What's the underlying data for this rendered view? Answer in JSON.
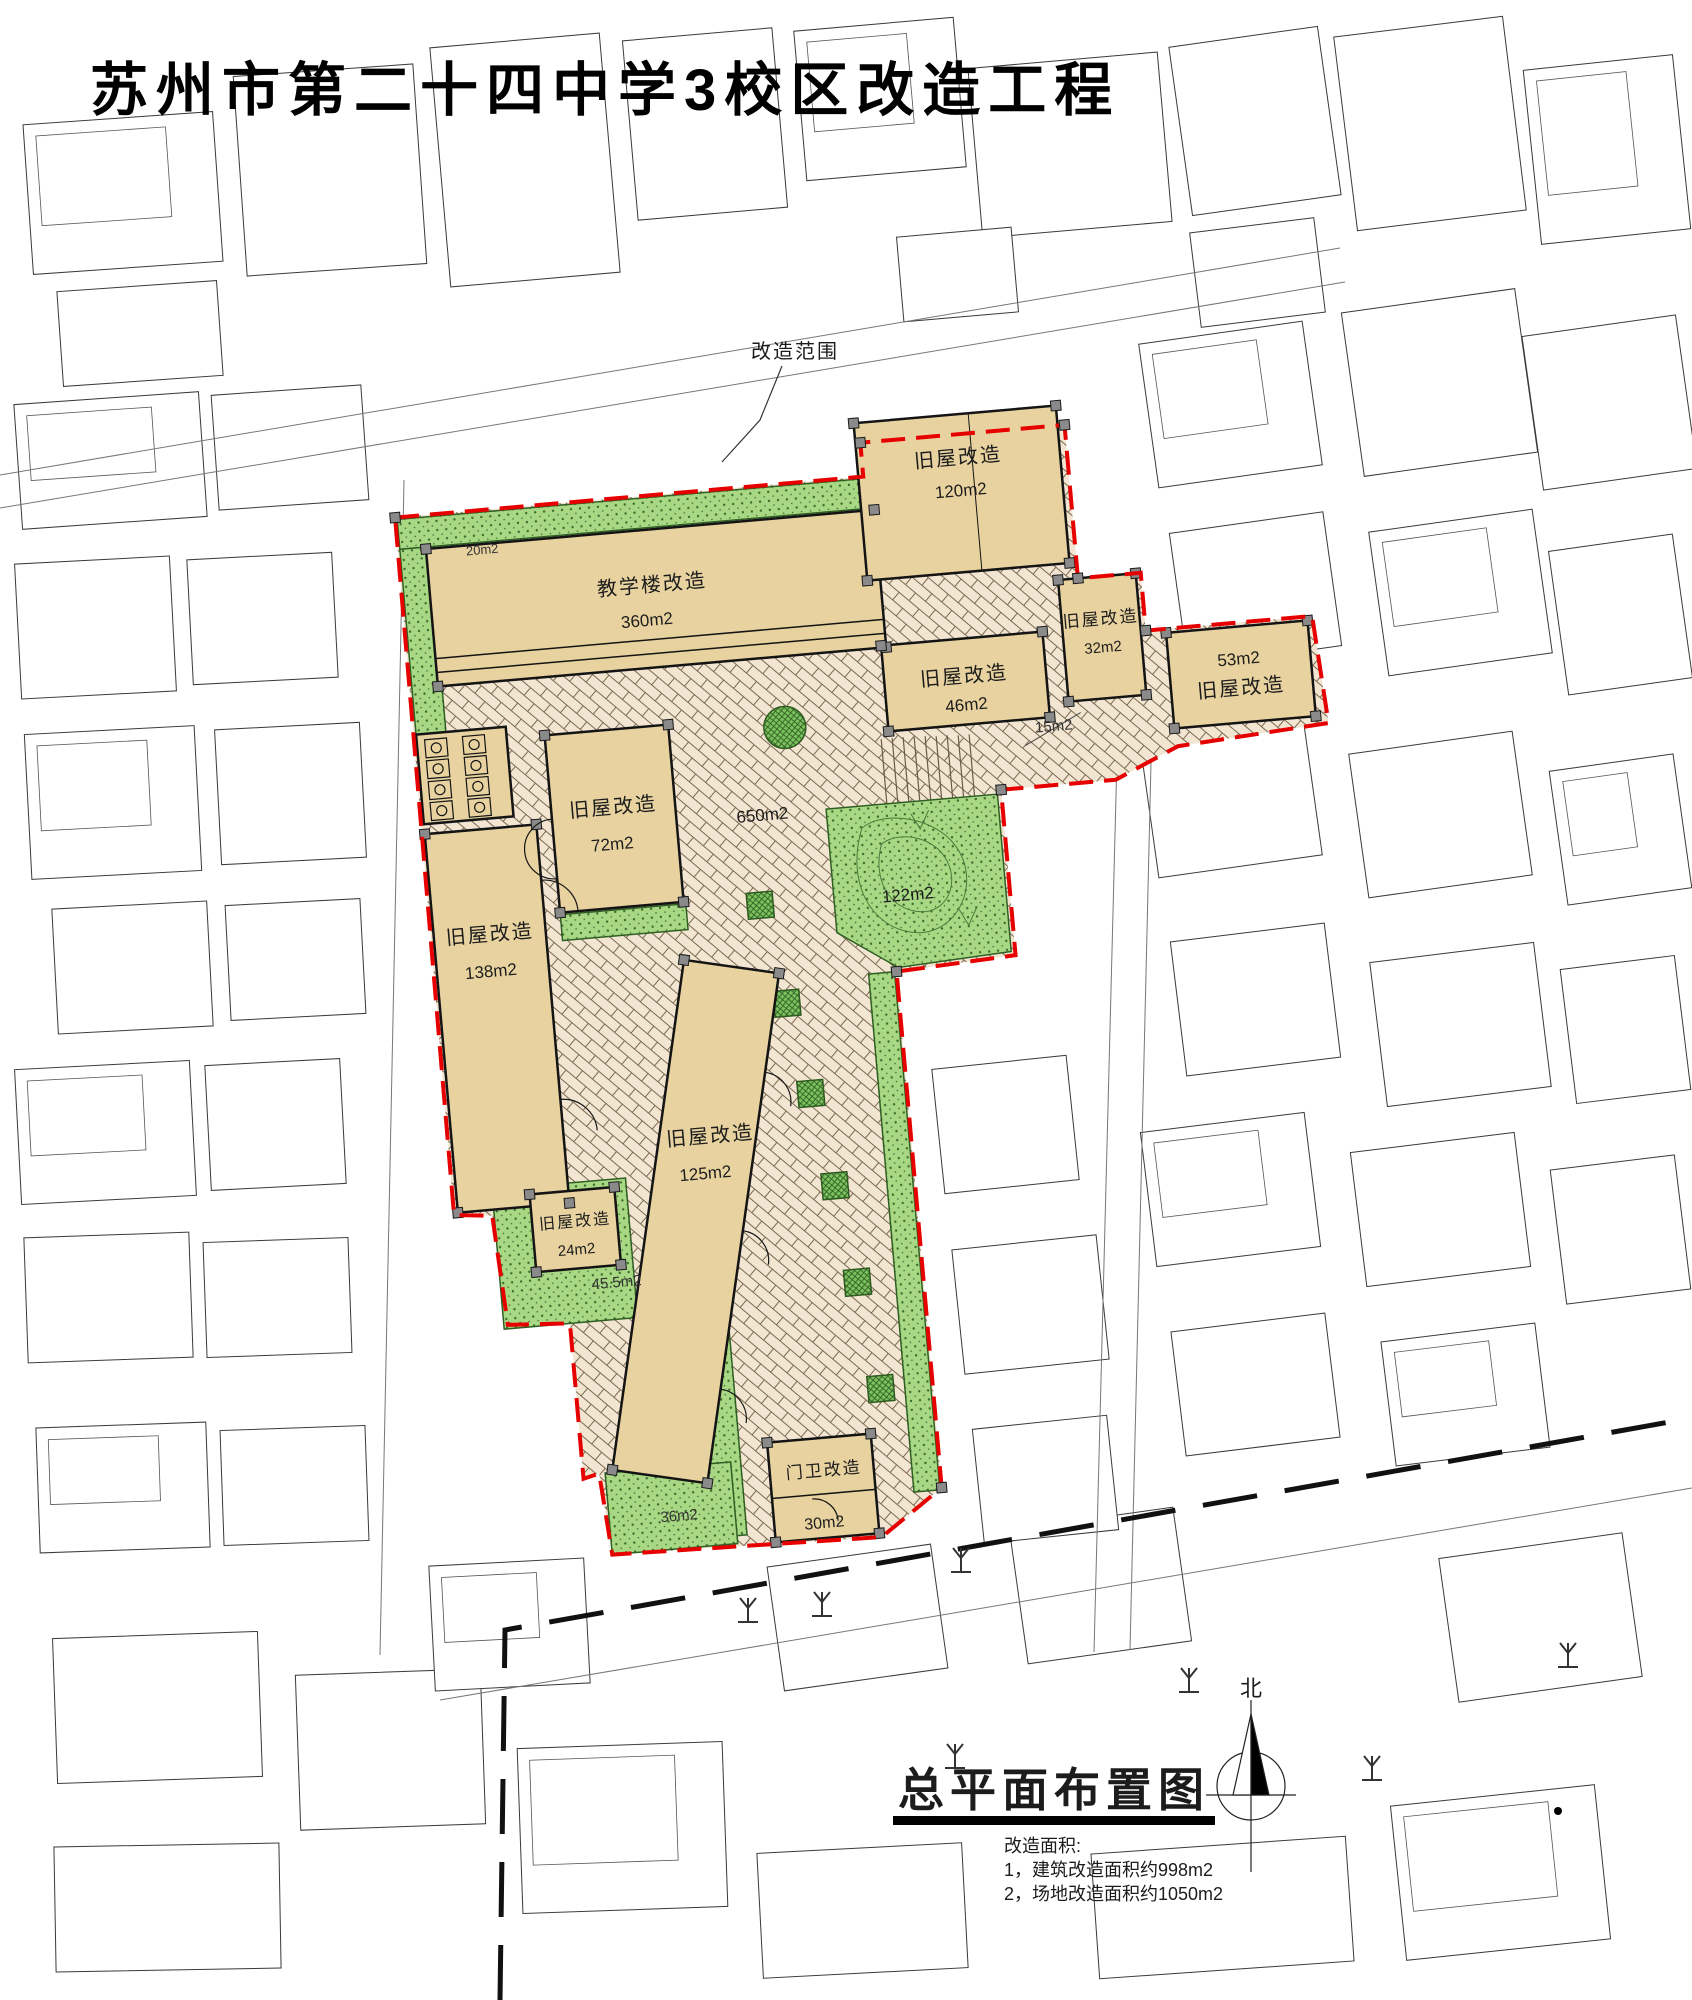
{
  "title": "苏州市第二十四中学3校区改造工程",
  "map": {
    "scope_label": "改造范围",
    "buildings": [
      {
        "name": "教学楼改造",
        "area": "360m2"
      },
      {
        "name": "旧屋改造",
        "area": "120m2"
      },
      {
        "name": "旧屋改造",
        "area": "46m2"
      },
      {
        "name": "旧屋改造",
        "area": "32m2"
      },
      {
        "name": "旧屋改造",
        "area": "53m2"
      },
      {
        "name": "旧屋改造",
        "area": "72m2"
      },
      {
        "name": "旧屋改造",
        "area": "138m2"
      },
      {
        "name": "旧屋改造",
        "area": "125m2"
      },
      {
        "name": "旧屋改造",
        "area": "24m2"
      },
      {
        "name": "门卫改造",
        "area": "30m2"
      }
    ],
    "area_labels": {
      "courtyard": "650m2",
      "passage": "15m2",
      "lawn_large": "122m2",
      "lawn_small": "45.5m2",
      "lawn_gate": "36m2",
      "lawn_strip": "20m2"
    }
  },
  "legend": {
    "title": "总平面布置图",
    "notes_heading": "改造面积:",
    "note1": "1，建筑改造面积约998m2",
    "note2": "2，场地改造面积约1050m2"
  },
  "north_label": "北",
  "colors": {
    "boundary_red": "#e60000",
    "building_fill": "#e8d3a0",
    "lawn_green": "#a9d884",
    "paving_base": "#f2e6d2"
  }
}
